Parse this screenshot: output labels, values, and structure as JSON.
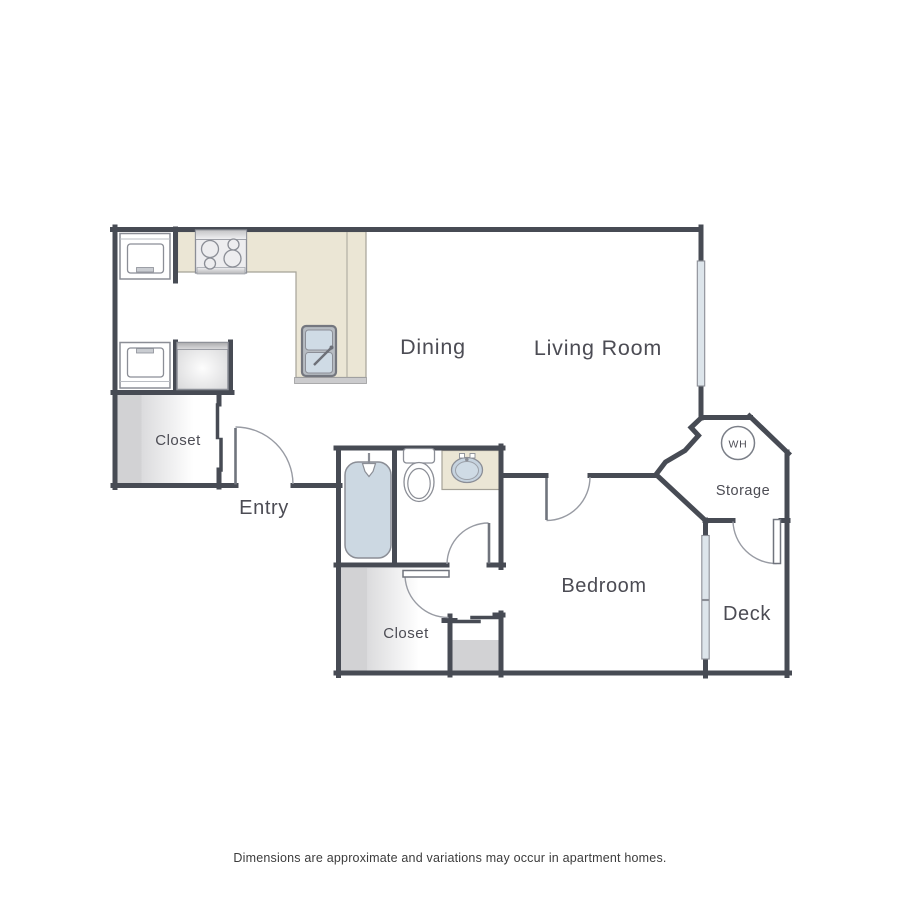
{
  "labels": {
    "dining": "Dining",
    "living_room": "Living Room",
    "entry": "Entry",
    "bedroom": "Bedroom",
    "closet_upper": "Closet",
    "closet_lower": "Closet",
    "storage": "Storage",
    "deck": "Deck",
    "water_heater": "WH"
  },
  "disclaimer": "Dimensions are approximate and variations may occur in apartment homes.",
  "colors": {
    "wall": "#474b54",
    "door_leaf": "#70747d",
    "door_arc": "#989ba3",
    "fixture_outline": "#8b8e96",
    "counter": "#ebe6d5",
    "counter_edge": "#a5a298",
    "water": "#ccd8e2",
    "window": "#dde5eb",
    "closet_shade": "#d2d2d4",
    "label_text": "#4c4c54",
    "disclaimer_text": "#3c3c3c"
  }
}
